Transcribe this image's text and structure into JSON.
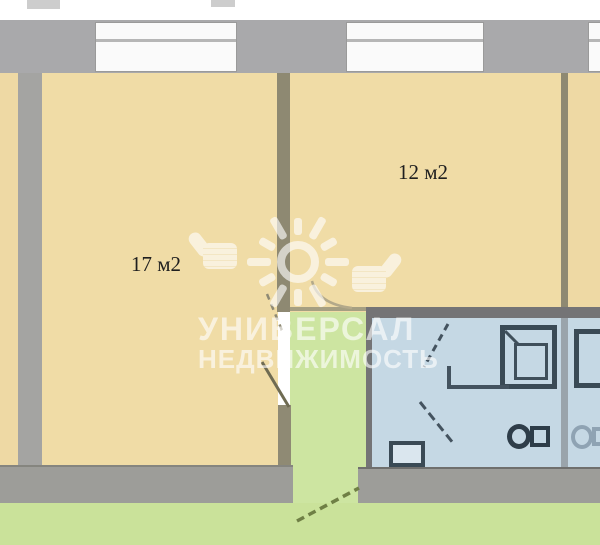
{
  "page": {
    "type": "apartment-floor-plan"
  },
  "rooms": {
    "room17_label": "17 м2",
    "room12_label": "12 м2"
  },
  "watermark": {
    "brand_line1": "УНИВЕРСАЛ",
    "brand_line2": "НЕДВИЖИМОСТЬ"
  },
  "colors": {
    "outer_wall_gray": "#a9a9ab",
    "inner_wall_olive": "#8e8972",
    "room_fill_beige": "#f0dca6",
    "bathroom_fill_blue": "#c5d8e4",
    "ground_green": "#cae29a",
    "bottom_wall_gray": "#9d9d99",
    "fixture_outline": "#3a4a55",
    "watermark_white": "#ffffff",
    "label_text": "#1f1f1f"
  }
}
